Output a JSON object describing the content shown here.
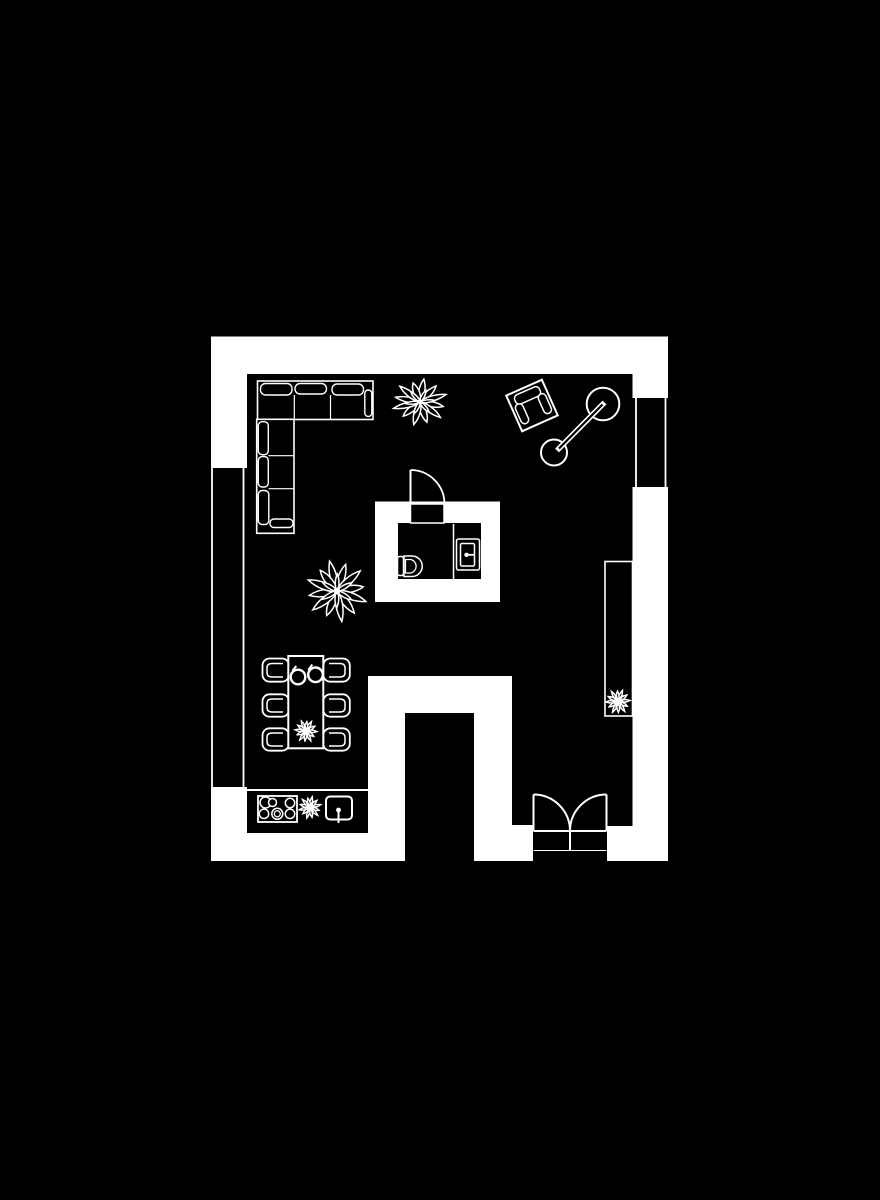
{
  "meta": {
    "title": "apartment-floor-plan",
    "background_color": "#000000",
    "line_color": "#ffffff"
  },
  "labels": {
    "plan": "Floor plan",
    "walls": "Walls",
    "window_left": "Window in left wall",
    "window_right": "Window in right wall",
    "sofa": "Corner sofa",
    "plant_top": "Plant",
    "plant_large": "Large plant",
    "armchair": "Armchair",
    "floor_lamp": "Floor lamp",
    "bathroom": "Bathroom",
    "bathroom_door": "Bathroom door",
    "toilet": "Toilet",
    "vanity_sink": "Bathroom sink",
    "dining_table": "Dining table",
    "dining_chair": "Dining chair",
    "mug": "Cup",
    "table_plant": "Table plant",
    "kitchen_counter": "Kitchen counter",
    "stove": "Cooktop",
    "kitchen_sink": "Kitchen sink",
    "counter_plant": "Counter plant",
    "sideboard": "Sideboard",
    "sideboard_plant": "Sideboard plant",
    "entry_door": "Double entry door"
  }
}
